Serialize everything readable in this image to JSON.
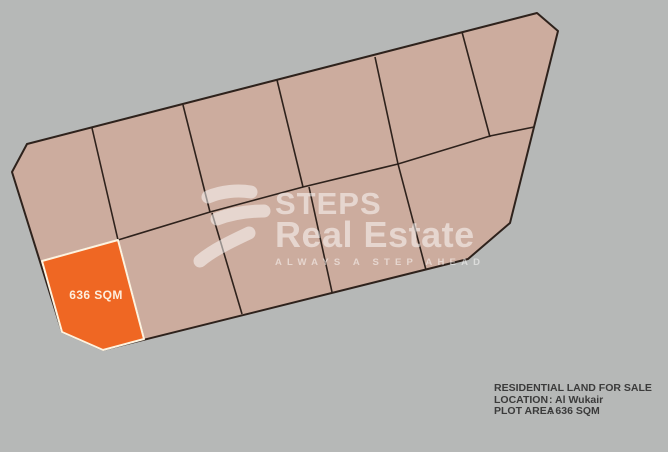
{
  "background_color": "#b6b8b7",
  "map": {
    "colors": {
      "block_fill": "#ccac9e",
      "line": "#2e221c",
      "highlight_fill": "#ef6723",
      "highlight_stroke": "#fdf3e0",
      "label_color": "#fdeedd"
    },
    "geometry": {
      "block_outline": [
        [
          12,
          172
        ],
        [
          27,
          144
        ],
        [
          537,
          13
        ],
        [
          558,
          31
        ],
        [
          510,
          223
        ],
        [
          468,
          259
        ],
        [
          103,
          350
        ],
        [
          62,
          332
        ]
      ],
      "row_divider": [
        [
          42,
          261
        ],
        [
          118,
          240
        ],
        [
          210,
          212
        ],
        [
          303,
          187
        ],
        [
          398,
          164
        ],
        [
          490,
          136
        ],
        [
          534,
          127
        ]
      ],
      "plot_dividers": [
        [
          [
            92,
            128
          ],
          [
            118,
            240
          ]
        ],
        [
          [
            183,
            105
          ],
          [
            210,
            212
          ]
        ],
        [
          [
            277,
            80
          ],
          [
            303,
            187
          ]
        ],
        [
          [
            375,
            57
          ],
          [
            398,
            164
          ],
          [
            426,
            270
          ]
        ],
        [
          [
            462,
            32
          ],
          [
            490,
            137
          ]
        ],
        [
          [
            118,
            240
          ],
          [
            144,
            339
          ]
        ],
        [
          [
            212,
            213
          ],
          [
            242,
            314
          ]
        ],
        [
          [
            309,
            187
          ],
          [
            332,
            292
          ]
        ]
      ],
      "highlight_plot": [
        [
          42,
          261
        ],
        [
          118,
          240
        ],
        [
          144,
          339
        ],
        [
          103,
          350
        ],
        [
          62,
          332
        ]
      ]
    },
    "highlight": {
      "label": "636 SQM"
    }
  },
  "watermark": {
    "brand_top": "STEPS",
    "brand_bottom": "Real Estate",
    "tagline": "ALWAYS A STEP AHEAD",
    "color": "#ffffff",
    "opacity": 0.5,
    "icon": "steps-brush-s"
  },
  "info": {
    "title": "RESIDENTIAL LAND FOR SALE",
    "location_label": "LOCATION",
    "location_value": ": Al Wukair",
    "area_label": "PLOT AREA",
    "area_value": ": 636  SQM",
    "text_color": "#3b3b3b"
  }
}
